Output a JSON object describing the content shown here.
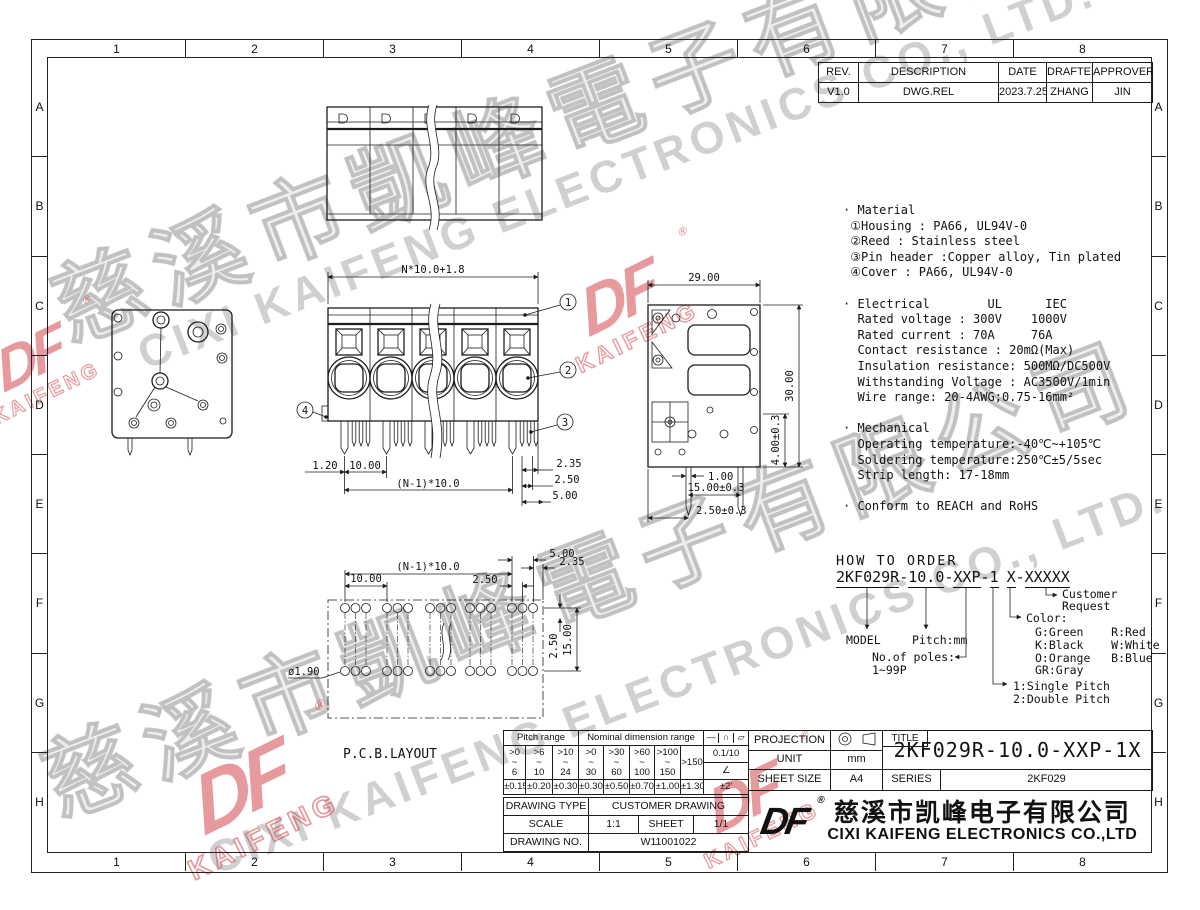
{
  "sheet": {
    "bg": "#ffffff",
    "line_color": "#1c1c1c",
    "red": "#d5494e",
    "watermark_gray": "#8a8a8a"
  },
  "border": {
    "cols": [
      "1",
      "2",
      "3",
      "4",
      "5",
      "6",
      "7",
      "8"
    ],
    "rows": [
      "A",
      "B",
      "C",
      "D",
      "E",
      "F",
      "G",
      "H"
    ]
  },
  "revision_table": {
    "headers": [
      "REV.",
      "DESCRIPTION",
      "DATE",
      "DRAFTER",
      "APPROVER"
    ],
    "row": [
      "V1.0",
      "DWG.REL",
      "2023.7.25",
      "ZHANG",
      "JIN"
    ]
  },
  "specs": {
    "lines": [
      "· Material",
      " ①Housing : PA66, UL94V-0",
      " ②Reed : Stainless steel",
      " ③Pin header :Copper alloy, Tin plated",
      " ④Cover : PA66, UL94V-0",
      "",
      "· Electrical        UL      IEC",
      "  Rated voltage : 300V    1000V",
      "  Rated current : 70A     76A",
      "  Contact resistance : 20mΩ(Max)",
      "  Insulation resistance: 500MΩ/DC500V",
      "  Withstanding Voltage : AC3500V/1min",
      "  Wire range: 20-4AWG;0.75-16mm²",
      "",
      "· Mechanical",
      "  Operating temperature:-40℃~+105℃",
      "  Soldering temperature:250℃±5/5sec",
      "  Strip length: 17-18mm",
      "",
      "· Conform to REACH and RoHS"
    ]
  },
  "views": {
    "front": {
      "dim_top": "N*10.0+1.8",
      "dim_left": "1.20",
      "dim_pitch": "10.00",
      "dim_row": "(N-1)*10.0",
      "dim_235": "2.35",
      "dim_250": "2.50",
      "dim_500": "5.00",
      "balloon_1": "1",
      "balloon_2": "2",
      "balloon_3": "3",
      "balloon_4": "4"
    },
    "side": {
      "dim_width": "29.00",
      "dim_height": "30.00",
      "dim_pin": "4.00±0.3",
      "dim_100": "1.00",
      "dim_1500": "15.00±0.3",
      "dim_250": "2.50±0.3"
    },
    "pcb": {
      "label": "P.C.B.LAYOUT",
      "dim_row": "(N-1)*10.0",
      "dim_pitch": "10.00",
      "dim_250": "2.50",
      "dim_500": "5.00",
      "dim_235": "2.35",
      "dim_v250": "2.50",
      "dim_v1500": "15.00",
      "dim_hole": "ø1.90"
    }
  },
  "how_to_order": {
    "heading": "HOW TO ORDER",
    "code": {
      "model": "2KF029R",
      "d1": "-",
      "pitch": "10.0",
      "d2": "-",
      "poles": "XXP",
      "d3": "-",
      "single": "1",
      "color": "X",
      "d4": "-",
      "custom": "XXXXX"
    },
    "labels": {
      "model": "MODEL",
      "pitch": "Pitch:mm",
      "poles_1": "No.of poles:",
      "poles_2": "1~99P",
      "color": "Color:",
      "color_lines": [
        "G:Green    R:Red",
        "K:Black    W:White",
        "O:Orange   B:Blue",
        "GR:Gray"
      ],
      "single_1": "1:Single Pitch",
      "single_2": "2:Double Pitch",
      "customer_1": "Customer",
      "customer_2": "Request"
    }
  },
  "tolerance_table": {
    "pitch_header": "Pitch range",
    "nominal_header": "Nominal dimension range",
    "symbols": [
      "—",
      "∩",
      "▱"
    ],
    "tilde": "~",
    "ranges": [
      {
        "from": ">0",
        "to": "6"
      },
      {
        "from": ">6",
        "to": "10"
      },
      {
        "from": ">10",
        "to": "24"
      },
      {
        "from": ">0",
        "to": "30"
      },
      {
        "from": ">30",
        "to": "60"
      },
      {
        "from": ">60",
        "to": "100"
      },
      {
        "from": ">100",
        "to": "150"
      }
    ],
    "over": ">150",
    "flatness": "0.1/10",
    "angle_symbol": "∠",
    "tolerances": [
      "±0.15",
      "±0.20",
      "±0.30",
      "±0.30",
      "±0.50",
      "±0.70",
      "±1.00",
      "±1.30"
    ],
    "angle_tol": "±2'"
  },
  "info_table": {
    "drawing_type_label": "DRAWING TYPE",
    "drawing_type": "CUSTOMER DRAWING",
    "scale_label": "SCALE",
    "scale": "1:1",
    "sheet_label": "SHEET",
    "sheet": "1/1",
    "drawing_no_label": "DRAWING NO.",
    "drawing_no": "W11001022"
  },
  "title_block": {
    "projection_label": "PROJECTION",
    "unit_label": "UNIT",
    "unit": "mm",
    "sheet_size_label": "SHEET SIZE",
    "sheet_size": "A4",
    "title_label": "TITLE",
    "title": "2KF029R-10.0-XXP-1X",
    "series_label": "SERIES",
    "series": "2KF029"
  },
  "company": {
    "logo": "DF",
    "reg": "®",
    "name_cn": "慈溪市凯峰电子有限公司",
    "name_en": "CIXI KAIFENG ELECTRONICS CO.,LTD"
  },
  "watermark": {
    "cn": "慈溪市凱峰電子有限公司",
    "en": "CIXI KAIFENG ELECTRONICS CO., LTD.",
    "logo_df": "DF",
    "logo_kaifeng": "KAIFENG",
    "reg": "®"
  }
}
